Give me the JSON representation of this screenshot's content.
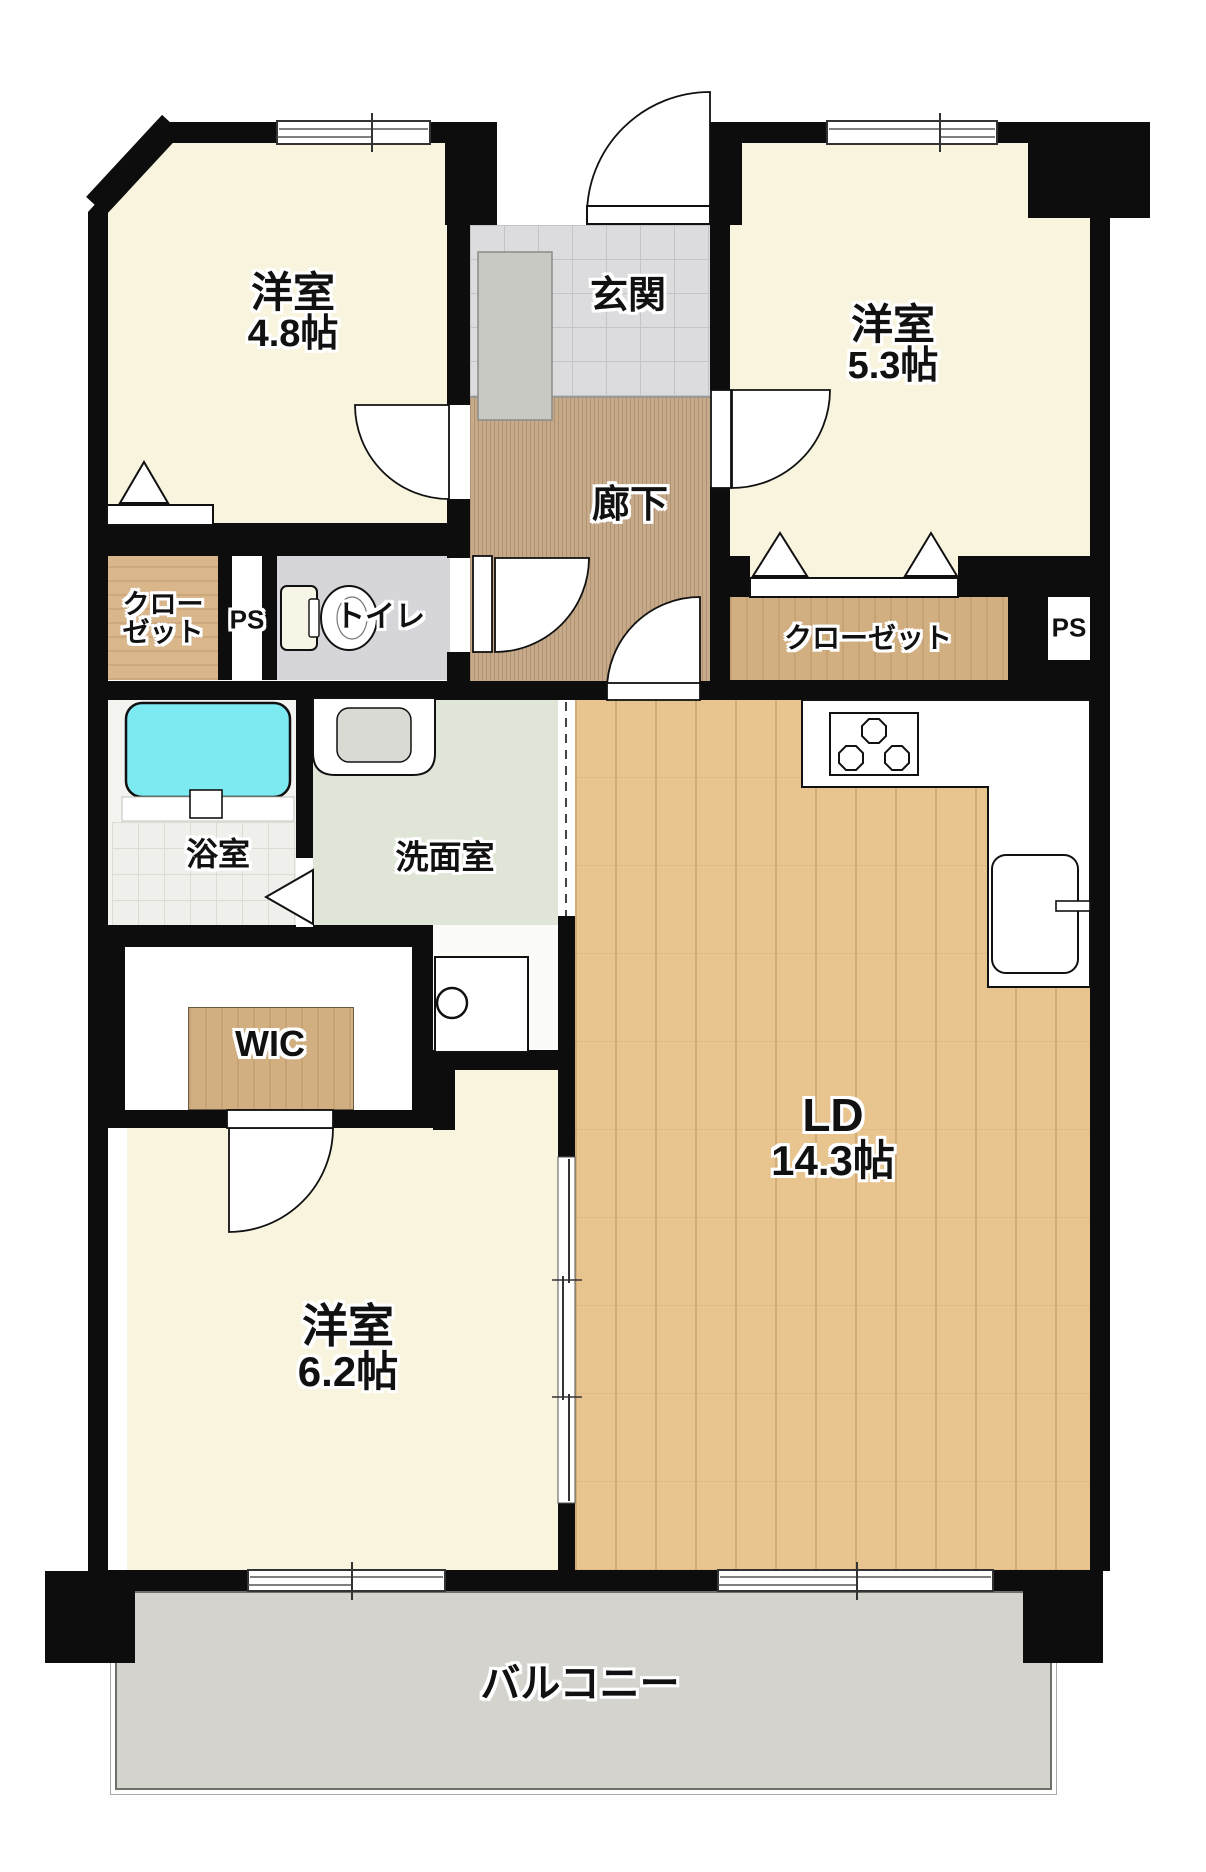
{
  "rooms": {
    "room48": {
      "name": "洋室",
      "size": "4.8帖"
    },
    "room53": {
      "name": "洋室",
      "size": "5.3帖"
    },
    "room62": {
      "name": "洋室",
      "size": "6.2帖"
    },
    "living": {
      "name": "LD",
      "size": "14.3帖"
    },
    "entrance": {
      "name": "玄関"
    },
    "corridor": {
      "name": "廊下"
    },
    "toilet": {
      "name": "トイレ"
    },
    "bath": {
      "name": "浴室"
    },
    "washroom": {
      "name": "洗面室"
    },
    "wic": {
      "name": "WIC"
    },
    "closet_left": {
      "line1": "クロー",
      "line2": "ゼット"
    },
    "closet_right": {
      "name": "クローゼット"
    },
    "ps_left": {
      "name": "PS"
    },
    "ps_right": {
      "name": "PS"
    },
    "balcony": {
      "name": "バルコニー"
    }
  },
  "colors": {
    "wall": "#0d0d0d",
    "room_floor": "#f8f4dd",
    "ld_wood_floor": "#e8c48f",
    "closet_wood": "#d2af81",
    "corridor_carpet": "#c7aa89",
    "entrance_tile": "#dcdcdf",
    "washroom_floor": "#e0e6d7",
    "toilet_floor": "#d6d6da",
    "balcony_floor": "#d4d3ce",
    "bathtub": "#7deaf2"
  }
}
